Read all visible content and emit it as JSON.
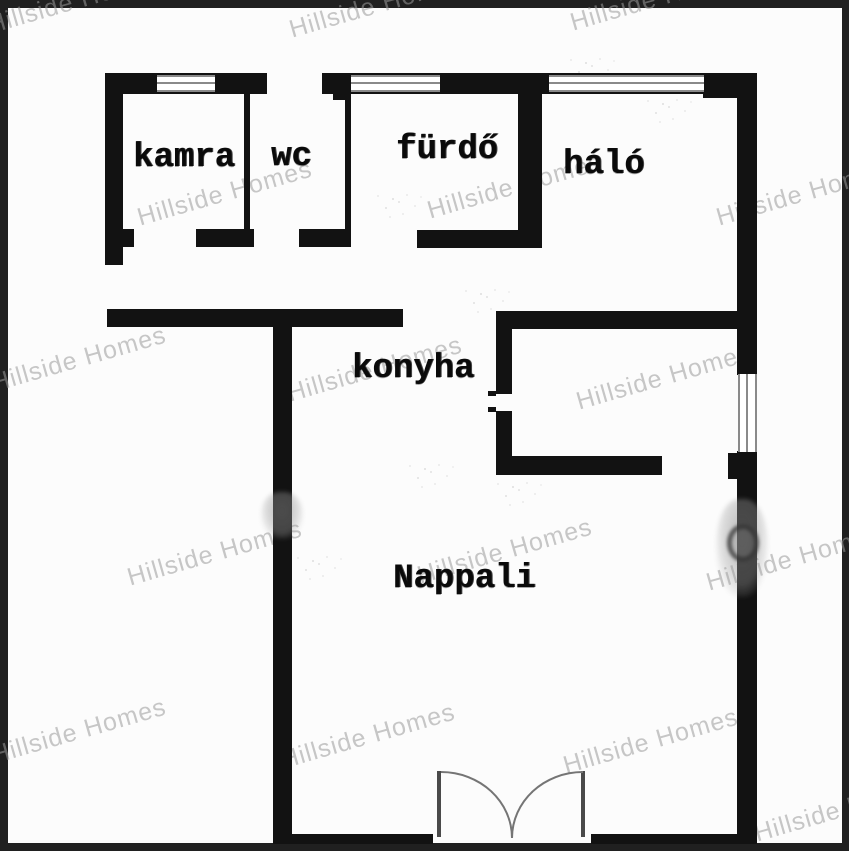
{
  "figure": "floor-plan",
  "watermark": {
    "text": "Hillside Homes"
  },
  "rooms": [
    {
      "id": "kamra",
      "label": "kamra"
    },
    {
      "id": "wc",
      "label": "wc"
    },
    {
      "id": "furdo",
      "label": "fürdő"
    },
    {
      "id": "halo",
      "label": "háló"
    },
    {
      "id": "konyha",
      "label": "konyha"
    },
    {
      "id": "nappali",
      "label": "Nappali"
    }
  ],
  "colors": {
    "wall": "#121212",
    "background": "#fcfcfc",
    "frame": "#202020",
    "window_line": "#8a8a8a",
    "door_arc": "#757575",
    "label": "#0a0a0a",
    "watermark": "#9a9a9a"
  }
}
